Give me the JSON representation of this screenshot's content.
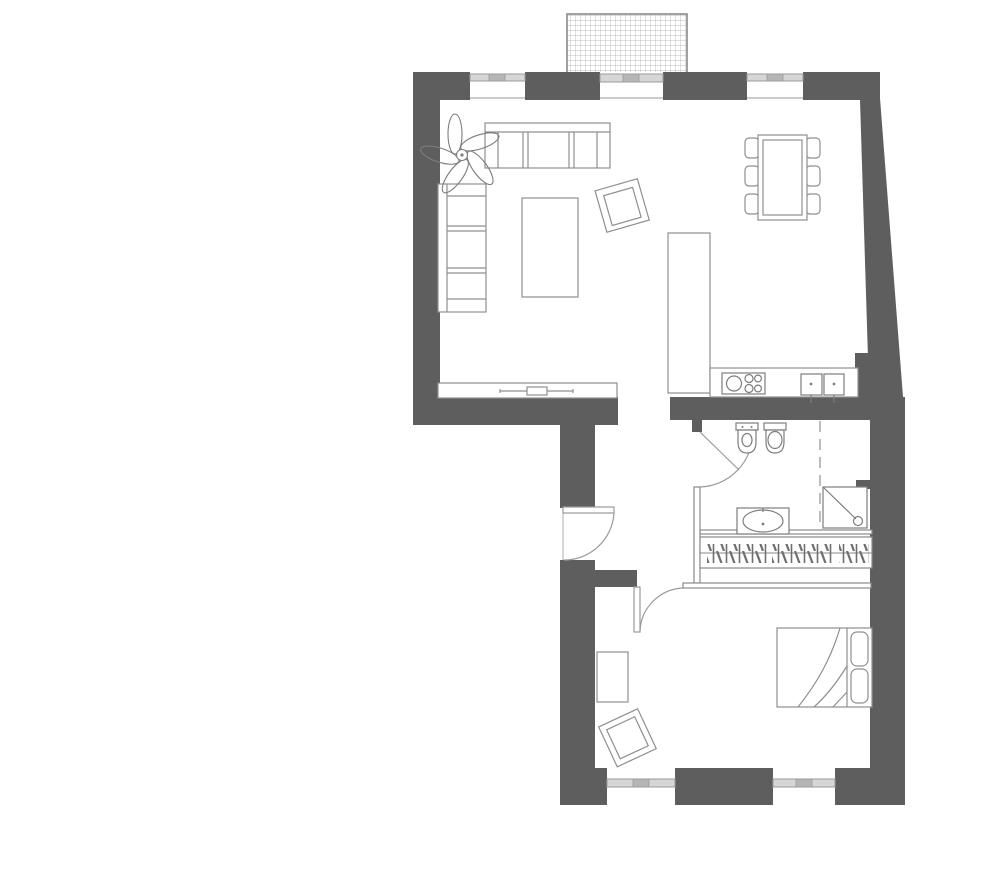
{
  "document": {
    "type": "apartment-floor-plan",
    "visible_text": []
  },
  "colors": {
    "background": "#ffffff",
    "wall_fill": "#5e5e5e",
    "furniture_line": "#8f8f8f",
    "fixture_line": "#7d7d7d",
    "window_band_fill": "#d6d6d6",
    "window_tick_fill": "#b5b5b5",
    "window_line": "#9a9a9a",
    "balcony_grid_line": "#a8a8a8",
    "balcony_border": "#8a8a8a",
    "door_arc": "#9a9a9a"
  },
  "symbols": [
    "balcony-grating",
    "window",
    "balcony-door",
    "sofa-three-seat",
    "sofa-two-seat",
    "coffee-table",
    "armchair",
    "potted-plant",
    "tv-console",
    "dining-table",
    "dining-chair",
    "kitchen-island",
    "kitchen-counter",
    "cooktop",
    "double-sink",
    "entry-door",
    "bathroom-door",
    "bedroom-door",
    "bidet",
    "toilet",
    "washbasin-vanity",
    "shower",
    "glass-partition",
    "wardrobe-hanging-rail",
    "double-bed",
    "desk",
    "bedroom-chair"
  ]
}
